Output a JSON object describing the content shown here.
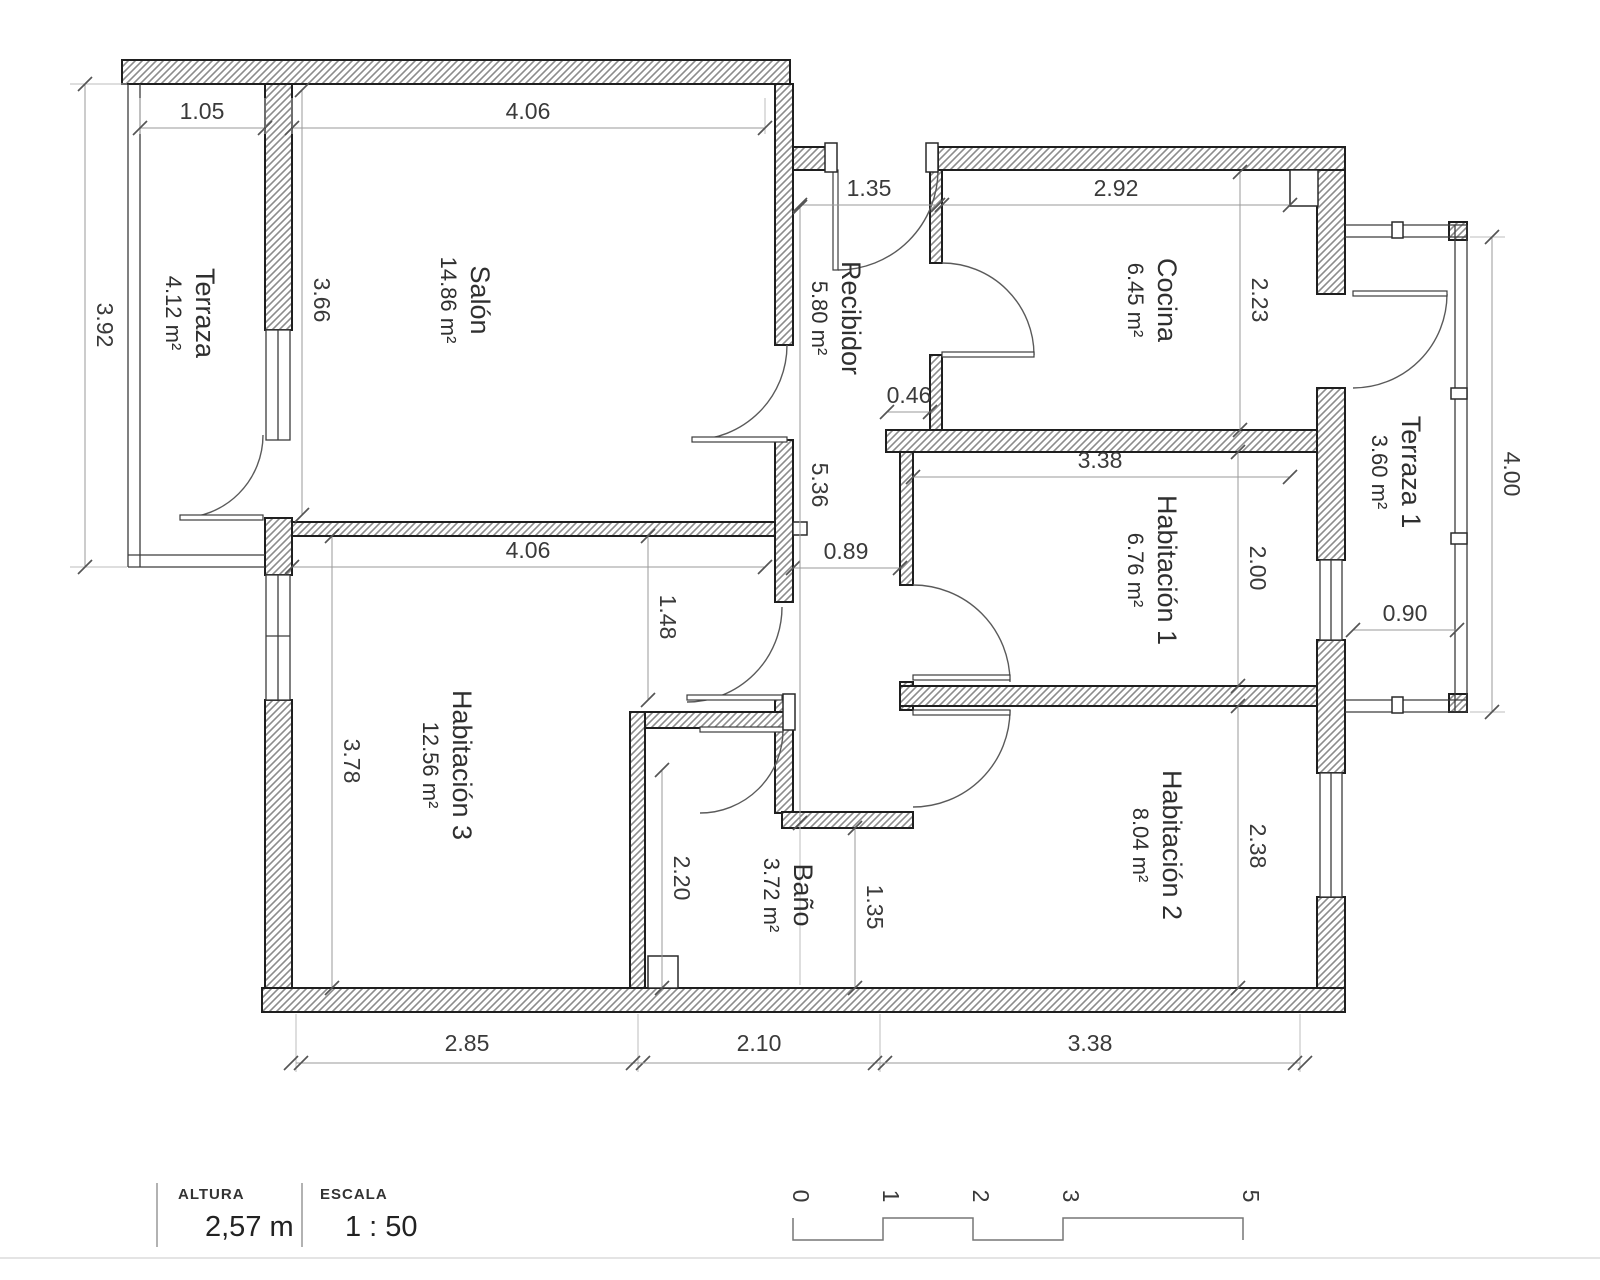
{
  "document": {
    "type": "architectural-floor-plan"
  },
  "rooms": [
    {
      "id": "terraza",
      "name": "Terraza",
      "area": "4.12 m²"
    },
    {
      "id": "salon",
      "name": "Salón",
      "area": "14.86 m²"
    },
    {
      "id": "recibidor",
      "name": "Recibidor",
      "area": "5.80 m²"
    },
    {
      "id": "cocina",
      "name": "Cocina",
      "area": "6.45 m²"
    },
    {
      "id": "terraza1",
      "name": "Terraza 1",
      "area": "3.60 m²"
    },
    {
      "id": "habitacion1",
      "name": "Habitación 1",
      "area": "6.76 m²"
    },
    {
      "id": "habitacion2",
      "name": "Habitación 2",
      "area": "8.04 m²"
    },
    {
      "id": "habitacion3",
      "name": "Habitación 3",
      "area": "12.56 m²"
    },
    {
      "id": "bano",
      "name": "Baño",
      "area": "3.72 m²"
    }
  ],
  "dims_h": [
    {
      "value": "1.05"
    },
    {
      "value": "4.06"
    },
    {
      "value": "1.35"
    },
    {
      "value": "2.92"
    },
    {
      "value": "0.46"
    },
    {
      "value": "3.38"
    },
    {
      "value": "4.06"
    },
    {
      "value": "0.89"
    },
    {
      "value": "0.90"
    },
    {
      "value": "2.85"
    },
    {
      "value": "2.10"
    },
    {
      "value": "3.38"
    }
  ],
  "dims_v": [
    {
      "value": "3.92"
    },
    {
      "value": "3.66"
    },
    {
      "value": "2.23"
    },
    {
      "value": "5.36"
    },
    {
      "value": "2.00"
    },
    {
      "value": "1.48"
    },
    {
      "value": "3.78"
    },
    {
      "value": "2.38"
    },
    {
      "value": "2.20"
    },
    {
      "value": "1.35"
    },
    {
      "value": "4.00"
    }
  ],
  "legend": {
    "altura_label": "ALTURA",
    "altura_value": "2,57 m",
    "escala_label": "ESCALA",
    "escala_value": "1 : 50"
  },
  "scalebar": {
    "labels": [
      {
        "value": "0"
      },
      {
        "value": "1"
      },
      {
        "value": "2"
      },
      {
        "value": "3"
      },
      {
        "value": "5"
      }
    ]
  },
  "colors": {
    "background": "#ffffff",
    "wall_outline": "#1f1f1f",
    "hatch": "#8c8c8c",
    "dimension_line": "#9a9a9a",
    "text": "#3a3a3a"
  }
}
